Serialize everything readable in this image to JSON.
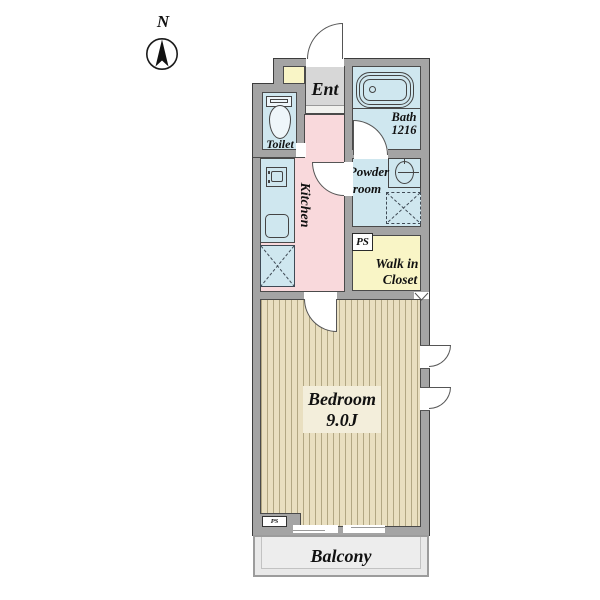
{
  "compass": {
    "label": "N"
  },
  "rooms": {
    "ent": {
      "label": "Ent"
    },
    "toilet": {
      "label": "Toilet"
    },
    "bath": {
      "label": "Bath",
      "size": "1216"
    },
    "kitchen": {
      "label": "Kitchen"
    },
    "powder_room": {
      "line1": "Powder",
      "line2": "room"
    },
    "pipe_space": {
      "label": "PS"
    },
    "walk_in_closet": {
      "line1": "Walk in",
      "line2": "Closet"
    },
    "bedroom": {
      "label": "Bedroom",
      "size": "9.0J"
    },
    "balcony": {
      "label": "Balcony"
    },
    "pipe_space_small": {
      "label": "PS"
    }
  },
  "colors": {
    "wall": "#a4a4a4",
    "wall_outline": "#3c3c3c",
    "wet_room_blue": "#cfe7ef",
    "hall_pink": "#f9d9dc",
    "entrance_gray": "#d7d7d7",
    "storage_yellow": "#f9f5c6",
    "flooring": "#e9dfc0",
    "flooring_stripe": "#b2a783",
    "balcony_gray": "#e9e9e9"
  }
}
